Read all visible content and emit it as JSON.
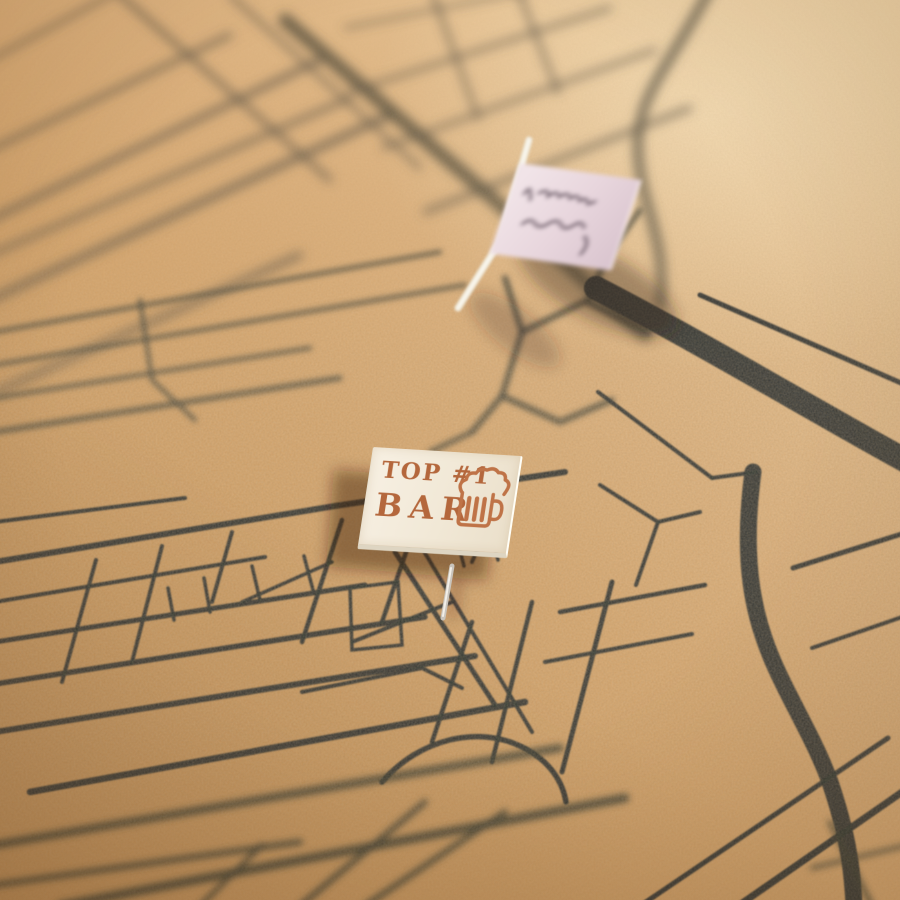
{
  "bar_label": {
    "line1": "TOP #1",
    "line2": "BAR",
    "icon": "beer-mug-icon",
    "text_color": "#b4673c",
    "tile_color": "#f3ecdd"
  },
  "flag_note": {
    "flag_color": "#ecdbe0",
    "ink_color": "#5c4c59",
    "icon": "handwriting-strokes"
  },
  "board": {
    "cork_highlight": "#efd2a4",
    "cork_mid": "#d4a46c",
    "cork_shadow": "#c5935a",
    "street_color": "#2c312e",
    "street_far_color": "#5a5343",
    "pin_metal_color": "#c9c4bc"
  }
}
